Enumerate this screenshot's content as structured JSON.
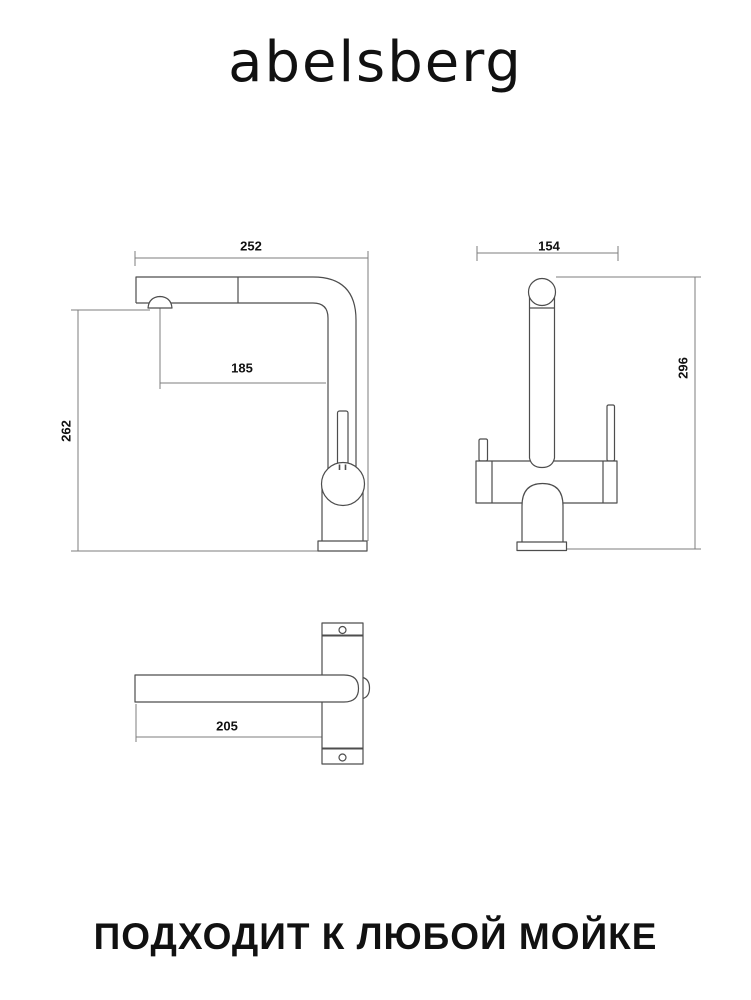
{
  "brand": {
    "logo_text": "abelsberg"
  },
  "footer": {
    "slogan": "ПОДХОДИТ К ЛЮБОЙ МОЙКЕ"
  },
  "drawing": {
    "side_view": {
      "top_width_mm": "252",
      "spout_reach_mm": "185",
      "height_mm": "262"
    },
    "front_view": {
      "top_width_mm": "154",
      "height_mm": "296"
    },
    "top_view": {
      "depth_mm": "205"
    }
  },
  "colors": {
    "outline": "#4d4d4d",
    "dimension": "#7d7d7d",
    "label_text": "#111111",
    "background": "#ffffff"
  }
}
